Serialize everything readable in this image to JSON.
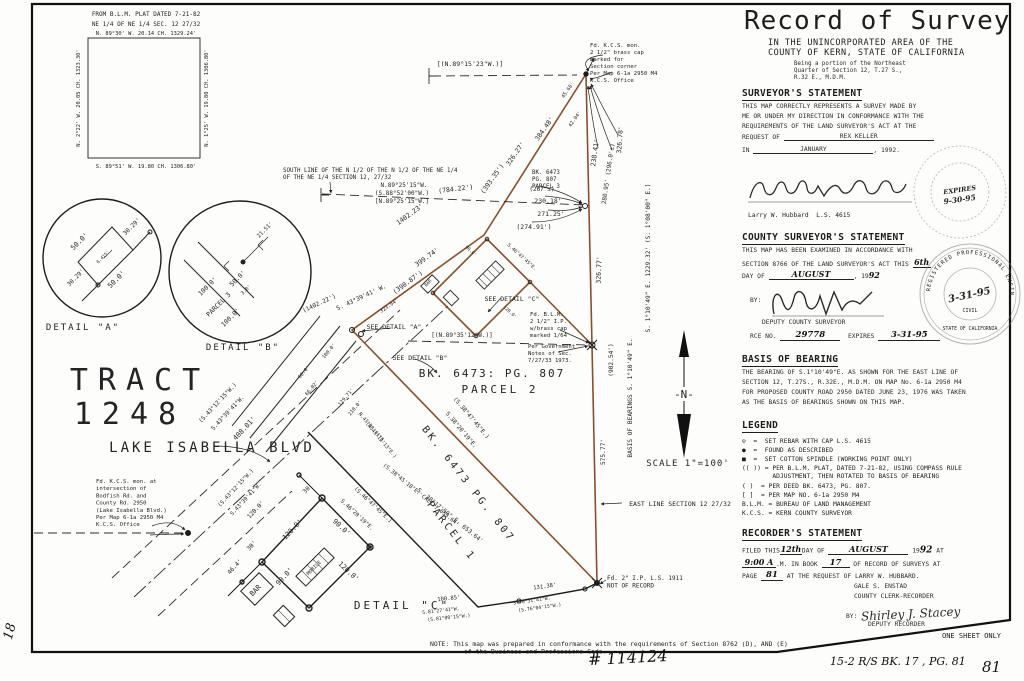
{
  "rp": {
    "title": "Record of Survey",
    "sub1": "IN THE UNINCORPORATED AREA OF THE",
    "sub2": "COUNTY OF KERN, STATE OF CALIFORNIA",
    "being": [
      "Being a portion of the Northeast",
      "Quarter of Section 12, T.27 S.,",
      "R.32 E., M.D.M."
    ],
    "surv": {
      "h": "SURVEYOR'S STATEMENT",
      "l1": "THIS MAP CORRECTLY REPRESENTS A SURVEY MADE BY",
      "l2": "ME OR UNDER MY DIRECTION IN CONFORMANCE WITH THE",
      "l3": "REQUIREMENTS OF THE LAND SURVEYOR'S ACT AT THE",
      "req": "REQUEST OF",
      "req_v": "REX KELLER",
      "in": "IN",
      "in_v": "JANUARY",
      "yr": ", 1992.",
      "name": "Larry W. Hubbard  L.S. 4615"
    },
    "cty": {
      "h": "COUNTY SURVEYOR'S STATEMENT",
      "l1": "THIS MAP HAS BEEN EXAMINED IN ACCORDANCE WITH",
      "l2": "SECTION 8766 OF THE LAND SURVEYOR'S ACT THIS",
      "day": "6th",
      "l3": "DAY OF",
      "mo": "AUGUST",
      "yrp": ", 19",
      "yr": "92",
      "by": "BY:",
      "dep": "DEPUTY COUNTY SURVEYOR",
      "rce": "RCE NO.",
      "rce_v": "29778",
      "exp": "EXPIRES",
      "exp_v": "3-31-95"
    },
    "bob": {
      "h": "BASIS OF BEARING",
      "lines": [
        "THE BEARING OF S.1°10'49\"E. AS SHOWN FOR THE EAST LINE OF",
        "SECTION 12, T.27S., R.32E., M.D.M. ON MAP No. 6-1a 2950 M4",
        "FOR PROPOSED COUNTY ROAD 2950 DATED JUNE 23, 1976 WAS TAKEN",
        "AS THE BASIS OF BEARINGS SHOWN ON THIS MAP."
      ]
    },
    "leg": {
      "h": "LEGEND",
      "items": [
        "⊙  =  SET REBAR WITH CAP L.S. 4615",
        "●  =  FOUND AS DESCRIBED",
        "■  =  SET COTTON SPINDLE (WORKING POINT ONLY)",
        "(( )) = PER B.L.M. PLAT, DATED 7-21-82, USING COMPASS RULE",
        "        ADJUSTMENT, THEN ROTATED TO BASIS OF BEARING",
        "( )  = PER DEED BK. 6473, PG. 807.",
        "[ ]  = PER MAP NO. 6-1a 2950 M4",
        "B.L.M. = BUREAU OF LAND MANAGEMENT",
        "K.C.S. = KERN COUNTY SURVEYOR"
      ]
    },
    "rec": {
      "h": "RECORDER'S STATEMENT",
      "f1": "FILED THIS",
      "day": "12th",
      "f2": "DAY OF",
      "mo": "AUGUST",
      "yrp": "19",
      "yr": "92",
      "at": "AT",
      "time": "9:00 A",
      "f3": ".M. IN BOOK",
      "book": "17",
      "f4": "OF RECORD OF SURVEYS AT",
      "f5": "PAGE",
      "page": "81",
      "f6": "AT THE REQUEST OF LARRY W. HUBBARD.",
      "clerk": "GALE S. ENSTAD",
      "clerk_t": "COUNTY CLERK-RECORDER",
      "by": "BY:",
      "sig": "Shirley J. Stacey",
      "dep": "DEPUTY RECORDER"
    },
    "one_sheet": "ONE SHEET ONLY",
    "stamp1": {
      "l1": "EXPIRES",
      "l2": "9-30-95"
    },
    "stamp2": {
      "ring": "REGISTERED PROFESSIONAL ENGINEER",
      "date": "3-31-95",
      "civil": "CIVIL",
      "ring2": "STATE OF CALIFORNIA"
    }
  },
  "footer": {
    "survey_no": "# 114124",
    "index": "15-2   R/S   BK. 17 , PG. 81",
    "page": "81",
    "margin": "18"
  },
  "map": {
    "ink": "#242424",
    "traverse_color": "#8a4f28",
    "labels": [
      {
        "t": "FROM B.L.M. PLAT DATED 7-21-82",
        "x": 146,
        "y": 16,
        "s": 6
      },
      {
        "t": "NE 1/4 OF NE 1/4 SEC. 12 27/32",
        "x": 146,
        "y": 26,
        "s": 6
      },
      {
        "t": "N. 89°30' W.   20.14 CH.   1329.24'",
        "x": 146,
        "y": 35,
        "s": 5.4
      },
      {
        "t": "N. 2°22' W.   20.05 CH.   1323.30'",
        "x": 80,
        "y": 98,
        "r": -90,
        "s": 5.4
      },
      {
        "t": "N. 1°25' W.   19.80 CH.   1306.80'",
        "x": 208,
        "y": 98,
        "r": -90,
        "s": 5.4
      },
      {
        "t": "S. 89°51' W.   19.80 CH.   1306.80'",
        "x": 146,
        "y": 168,
        "s": 5.4
      },
      {
        "t": "50.0'",
        "x": 81,
        "y": 243,
        "r": -45,
        "s": 7
      },
      {
        "t": "30.29'",
        "x": 133,
        "y": 228,
        "r": -45,
        "s": 6
      },
      {
        "t": "50.0'",
        "x": 118,
        "y": 281,
        "r": -45,
        "s": 7
      },
      {
        "t": "30.29'",
        "x": 77,
        "y": 279,
        "r": -45,
        "s": 6
      },
      {
        "t": "6.415'",
        "x": 104,
        "y": 258,
        "r": -45,
        "s": 4.5
      },
      {
        "t": "DETAIL  \"A\"",
        "x": 83,
        "y": 330,
        "s": 9,
        "ls": 2
      },
      {
        "t": "100.0'",
        "x": 209,
        "y": 288,
        "r": -45,
        "s": 6.5
      },
      {
        "t": "PARCEL 3",
        "x": 220,
        "y": 306,
        "r": -45,
        "s": 6.5
      },
      {
        "t": "100.0'",
        "x": 232,
        "y": 319,
        "r": -45,
        "s": 6.5
      },
      {
        "t": "50.0'",
        "x": 239,
        "y": 280,
        "r": -45,
        "s": 6.5
      },
      {
        "t": "3.0'",
        "x": 247,
        "y": 291,
        "r": -45,
        "s": 5
      },
      {
        "t": "21.51'",
        "x": 266,
        "y": 231,
        "r": -45,
        "s": 5.5
      },
      {
        "t": "DETAIL  \"B\"",
        "x": 243,
        "y": 350,
        "s": 9,
        "ls": 2
      },
      {
        "t": "TRACT",
        "x": 140,
        "y": 390,
        "s": 30,
        "ls": 10,
        "c": "#c9c9c9"
      },
      {
        "t": "1248",
        "x": 130,
        "y": 424,
        "s": 30,
        "ls": 10,
        "c": "#c9c9c9"
      },
      {
        "t": "LAKE  ISABELLA  BLVD",
        "x": 212,
        "y": 452,
        "s": 14,
        "ls": 3,
        "c": "#2a2a2a"
      },
      {
        "t": "[(N.89°15'23\"W.)]",
        "x": 470,
        "y": 66,
        "s": 6.5
      },
      {
        "t": "45.60'",
        "x": 569,
        "y": 91,
        "r": -55,
        "s": 5
      },
      {
        "t": "42.04'",
        "x": 576,
        "y": 120,
        "r": -55,
        "s": 5
      },
      {
        "t": "384.48'",
        "x": 546,
        "y": 130,
        "r": -55,
        "s": 6.5
      },
      {
        "t": "326.27'",
        "x": 517,
        "y": 155,
        "r": -55,
        "s": 6.5
      },
      {
        "t": "(393.35')",
        "x": 494,
        "y": 180,
        "r": -55,
        "s": 6.5
      },
      {
        "t": "238.41'",
        "x": 597,
        "y": 153,
        "r": -82,
        "s": 6.5
      },
      {
        "t": "280.95'  (296.0'±)",
        "x": 610,
        "y": 174,
        "r": -82,
        "s": 6
      },
      {
        "t": "326.78'",
        "x": 622,
        "y": 140,
        "r": -86,
        "s": 6.5
      },
      {
        "t": "(784.22')",
        "x": 456,
        "y": 191,
        "r": -7,
        "s": 6.5
      },
      {
        "t": "N.89°25'15\"W.",
        "x": 404,
        "y": 187,
        "s": 6
      },
      {
        "t": "(S.88°52'00\"W.)",
        "x": 402,
        "y": 195,
        "s": 6
      },
      {
        "t": "[N.89°25'15\"W.]",
        "x": 402,
        "y": 203,
        "s": 6
      },
      {
        "t": "(267'±)",
        "x": 542,
        "y": 191,
        "s": 6
      },
      {
        "t": "230.18'",
        "x": 548,
        "y": 203,
        "s": 6.5
      },
      {
        "t": "271.25'",
        "x": 551,
        "y": 216,
        "s": 6.5
      },
      {
        "t": "(274.91')",
        "x": 534,
        "y": 229,
        "s": 6.5
      },
      {
        "t": "1402.23'",
        "x": 411,
        "y": 216,
        "r": -36,
        "s": 6.5
      },
      {
        "t": "399.74'",
        "x": 428,
        "y": 259,
        "r": -36,
        "s": 6.5
      },
      {
        "t": "(390.87')",
        "x": 409,
        "y": 284,
        "r": -36,
        "s": 6.5
      },
      {
        "t": "(1402.22')",
        "x": 320,
        "y": 305,
        "r": -25,
        "s": 6
      },
      {
        "t": "S. 43°39'41' W.",
        "x": 362,
        "y": 299,
        "r": -25,
        "s": 6
      },
      {
        "t": "(S.43°12'15\"W.)",
        "x": 219,
        "y": 404,
        "r": -47,
        "s": 5.8
      },
      {
        "t": "S.43°39'41\"W.",
        "x": 229,
        "y": 414,
        "r": -47,
        "s": 5.8
      },
      {
        "t": "408.01'",
        "x": 246,
        "y": 430,
        "r": -47,
        "s": 7
      },
      {
        "t": "(S.43°12'15\"W.)",
        "x": 237,
        "y": 489,
        "r": -47,
        "s": 5.5
      },
      {
        "t": "S.43°39'41\"W.",
        "x": 247,
        "y": 500,
        "r": -47,
        "s": 5.5
      },
      {
        "t": "120.0'",
        "x": 257,
        "y": 511,
        "r": -47,
        "s": 6
      },
      {
        "t": "100.0'",
        "x": 330,
        "y": 352,
        "r": -50,
        "s": 5
      },
      {
        "t": "60.0'",
        "x": 305,
        "y": 373,
        "r": -50,
        "s": 5
      },
      {
        "t": "66.02'",
        "x": 313,
        "y": 389,
        "r": -50,
        "s": 5
      },
      {
        "t": "129.71'",
        "x": 347,
        "y": 398,
        "r": -50,
        "s": 5
      },
      {
        "t": "210.0'",
        "x": 356,
        "y": 409,
        "r": -50,
        "s": 5
      },
      {
        "t": "323.94'",
        "x": 390,
        "y": 307,
        "r": -35,
        "s": 5
      },
      {
        "t": "(S.38°47'45\"E.)",
        "x": 470,
        "y": 419,
        "r": 50,
        "s": 5.8
      },
      {
        "t": "S.38°20'19\"E.",
        "x": 460,
        "y": 431,
        "r": 50,
        "s": 5.8
      },
      {
        "t": "N.43°38'41\"E.",
        "x": 371,
        "y": 429,
        "r": 50,
        "s": 5
      },
      {
        "t": "(N.43°12'13\"E.)",
        "x": 380,
        "y": 441,
        "r": 50,
        "s": 5
      },
      {
        "t": "(S.38°45'18\"E. CALC.)   653.64'",
        "x": 420,
        "y": 496,
        "r": 39,
        "s": 5.5
      },
      {
        "t": "S. 38°17'50\" E.   653.64'",
        "x": 449,
        "y": 517,
        "r": 39,
        "s": 6
      },
      {
        "t": "BK. 6473 PG. 807",
        "x": 466,
        "y": 486,
        "r": 52,
        "s": 10,
        "ls": 3
      },
      {
        "t": "PARCEL 1",
        "x": 449,
        "y": 533,
        "r": 52,
        "s": 10,
        "ls": 3
      },
      {
        "t": "326.77'",
        "x": 601,
        "y": 270,
        "r": -88,
        "s": 6.5
      },
      {
        "t": "S. 1°10'49\" E.    1229.32'    (S. 1°08'00\" E.)",
        "x": 650,
        "y": 258,
        "r": -90,
        "s": 6.2
      },
      {
        "t": "(902.54')",
        "x": 613,
        "y": 360,
        "r": -90,
        "s": 6.2
      },
      {
        "t": "575.77'",
        "x": 605,
        "y": 452,
        "r": -90,
        "s": 6.2
      },
      {
        "t": "BASIS  OF  BEARINGS      S. 1°10'49\" E.",
        "x": 632,
        "y": 398,
        "r": -90,
        "s": 6.2
      },
      {
        "t": "EAST LINE SECTION 12 27/32",
        "x": 680,
        "y": 506,
        "s": 6.5
      },
      {
        "t": "BK.  6473:  PG.  807",
        "x": 492,
        "y": 377,
        "s": 11,
        "ls": 2
      },
      {
        "t": "PARCEL  2",
        "x": 500,
        "y": 393,
        "s": 11,
        "ls": 3
      },
      {
        "t": "30'",
        "x": 309,
        "y": 490,
        "r": -45,
        "s": 6
      },
      {
        "t": "(S.46°47'45\"E.)",
        "x": 372,
        "y": 506,
        "r": 43,
        "s": 5.5
      },
      {
        "t": "S.46°20'19\"E.",
        "x": 356,
        "y": 516,
        "r": 43,
        "s": 5.5
      },
      {
        "t": "90.0'",
        "x": 340,
        "y": 529,
        "r": 43,
        "s": 7
      },
      {
        "t": "120.0'",
        "x": 347,
        "y": 573,
        "r": 43,
        "s": 7
      },
      {
        "t": "90.0'",
        "x": 286,
        "y": 578,
        "r": -47,
        "s": 7
      },
      {
        "t": "120.0'",
        "x": 294,
        "y": 531,
        "r": -47,
        "s": 7
      },
      {
        "t": "30'",
        "x": 253,
        "y": 547,
        "r": -47,
        "s": 6
      },
      {
        "t": "46.4'",
        "x": 236,
        "y": 568,
        "r": -47,
        "s": 6
      },
      {
        "t": "MOBILE",
        "x": 315,
        "y": 569,
        "r": -45,
        "s": 5
      },
      {
        "t": "BAR",
        "x": 257,
        "y": 592,
        "r": -45,
        "s": 7
      },
      {
        "t": "DETAIL  \"C\"",
        "x": 402,
        "y": 609,
        "s": 11,
        "ls": 3
      },
      {
        "t": "100.85'",
        "x": 449,
        "y": 600,
        "r": -6,
        "s": 5.5
      },
      {
        "t": "S.81°27'41\"W.",
        "x": 441,
        "y": 612,
        "r": -6,
        "s": 4.8
      },
      {
        "t": "(S.81°00'15\"W.)",
        "x": 449,
        "y": 619,
        "r": -6,
        "s": 4.8
      },
      {
        "t": "131.38'",
        "x": 545,
        "y": 588,
        "r": -8,
        "s": 5.5
      },
      {
        "t": "S.76°31'41\"W.",
        "x": 532,
        "y": 602,
        "r": -8,
        "s": 4.8
      },
      {
        "t": "(S.76°04'15\"W.)",
        "x": 540,
        "y": 609,
        "r": -8,
        "s": 4.8
      },
      {
        "t": "SEE DETAIL  \"A\"",
        "x": 394,
        "y": 329,
        "s": 6.5
      },
      {
        "t": "SEE DETAIL  \"B\"",
        "x": 420,
        "y": 360,
        "s": 6.5
      },
      {
        "t": "SEE DETAIL  \"C\"",
        "x": 512,
        "y": 301,
        "s": 6.5
      },
      {
        "t": "[(N.89°35'12\"W.)]",
        "x": 462,
        "y": 337,
        "s": 6
      },
      {
        "t": "S.46°47'45\"E.",
        "x": 521,
        "y": 258,
        "r": 42,
        "s": 4.8
      },
      {
        "t": "90.0'",
        "x": 470,
        "y": 252,
        "r": 42,
        "s": 4.5
      },
      {
        "t": "120.0'",
        "x": 509,
        "y": 313,
        "r": 42,
        "s": 4.5
      },
      {
        "t": "BAR",
        "x": 429,
        "y": 284,
        "r": -45,
        "s": 4.5
      },
      {
        "t": "-N-",
        "x": 684,
        "y": 398,
        "s": 11,
        "c": "#111"
      },
      {
        "t": "SCALE    1\"=100'",
        "x": 688,
        "y": 466,
        "s": 9,
        "ls": 1
      }
    ],
    "notes": [
      {
        "id": "found-kcs-section-corner-note",
        "x": 590,
        "y": 47,
        "s": 5.6,
        "lh": 7,
        "lines": [
          "Fd. K.C.S. mon.",
          "2 1/2\" brass cap",
          "marked for",
          "Section corner",
          "Per Map 6-1a 2950 M4",
          "K.C.S. Office"
        ]
      },
      {
        "id": "found-blm-pipe-note",
        "x": 530,
        "y": 316,
        "s": 5.6,
        "lh": 7,
        "lines": [
          "Fd. B.L.M.",
          "2 1/2\" I.P.",
          "w/brass cap",
          "marked 1/64"
        ]
      },
      {
        "id": "blm-government-notes",
        "x": 528,
        "y": 348,
        "s": 5.6,
        "lh": 7,
        "lines": [
          "Per Government",
          "Notes of Sec.",
          "7/27/33 1973."
        ]
      },
      {
        "id": "found-kcs-intersection-note",
        "x": 96,
        "y": 483,
        "s": 5.6,
        "lh": 7.2,
        "lines": [
          "Fd. K.C.S. mon. at",
          "intersection of",
          "Bodfish Rd. and",
          "County Rd. 2950",
          "(Lake Isabella Blvd.)",
          "Per Map 6-1a 2950 M4",
          "K.C.S. Office"
        ]
      },
      {
        "id": "found-iron-pipe-note",
        "x": 607,
        "y": 580,
        "s": 6,
        "lh": 7.5,
        "lines": [
          "Fd. 2\" I.P. L.S. 1911",
          "NOT OF RECORD"
        ]
      },
      {
        "id": "south-line-note",
        "x": 283,
        "y": 172,
        "s": 5.8,
        "lh": 7.2,
        "lines": [
          "SOUTH LINE OF THE N 1/2 OF THE N 1/2 OF THE NE 1/4",
          "OF THE NE 1/4 SECTION 12, 27/32"
        ]
      },
      {
        "id": "parcel3-deed-note",
        "x": 532,
        "y": 174,
        "s": 5.8,
        "lh": 7,
        "lines": [
          "BK. 6473",
          "PG. 807",
          "PARCEL 3"
        ]
      },
      {
        "id": "conformance-note-line1",
        "x": 430,
        "y": 646,
        "s": 6.4,
        "lh": 7.5,
        "lines": [
          "NOTE:  This map was prepared in conformance with the requirements of Section 8762 (D), AND (E)"
        ]
      },
      {
        "id": "conformance-note-line2",
        "x": 464,
        "y": 653.5,
        "s": 6.4,
        "lh": 7.5,
        "lines": [
          "of the Business and Professions Code."
        ]
      }
    ]
  }
}
